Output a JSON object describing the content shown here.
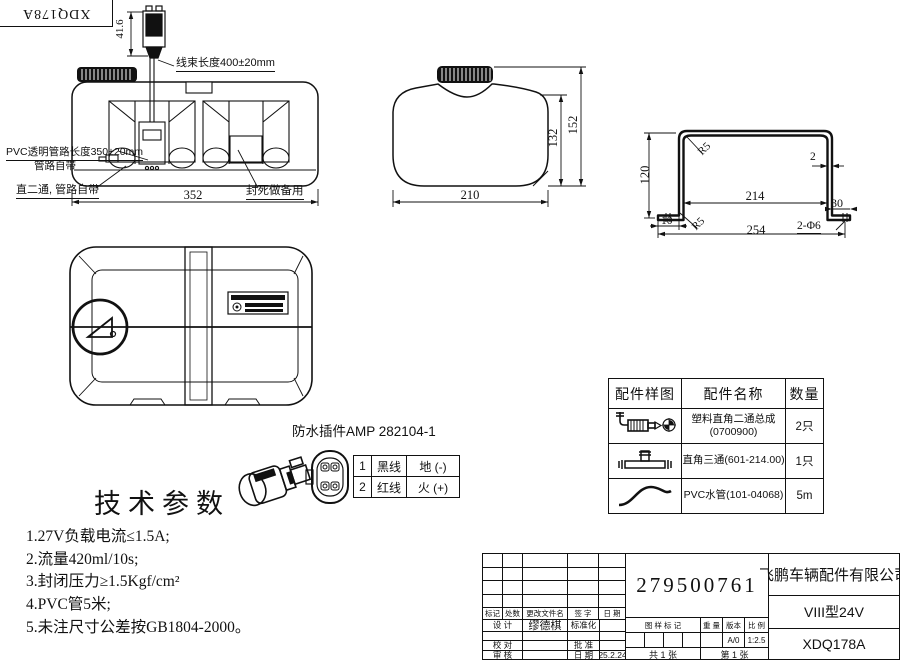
{
  "corner_stamp": "XDQ178A",
  "top_view": {
    "connector_height_dim": "41.6",
    "harness_label": "线束长度400±20mm",
    "pvc_label_1": "PVC透明管路长度350±20mm",
    "pvc_label_2": "管路自带",
    "tee_label": "直二通, 管路自带",
    "sealed_label": "封死做备用",
    "width_dim": "352"
  },
  "side_view": {
    "width_dim": "210",
    "inner_height_dim": "132",
    "outer_height_dim": "152"
  },
  "bracket": {
    "height_dim": "120",
    "inner_width_dim": "214",
    "outer_width_dim": "254",
    "right_flange_dim": "30",
    "left_flange_dim": "10",
    "thickness_dim": "2",
    "radius_top": "R5",
    "radius_bottom": "R5",
    "holes_label": "2-Φ6"
  },
  "connector": {
    "title": "防水插件AMP 282104-1",
    "rows": [
      {
        "no": "1",
        "wire": "黑线",
        "polarity": "地 (-)"
      },
      {
        "no": "2",
        "wire": "红线",
        "polarity": "火 (+)"
      }
    ]
  },
  "tech_params": {
    "title": "技术参数",
    "items": [
      "1.27V负载电流≤1.5A;",
      "2.流量420ml/10s;",
      "3.封闭压力≥1.5Kgf/cm²",
      "4.PVC管5米;",
      "5.未注尺寸公差按GB1804-2000。"
    ]
  },
  "parts_table": {
    "headers": [
      "配件样图",
      "配件名称",
      "数量"
    ],
    "rows": [
      {
        "icon": "elbow-two-way-fitting",
        "name": "塑料直角二通总成\n(0700900)",
        "qty": "2只"
      },
      {
        "icon": "tee-fitting",
        "name": "直角三通(601-214.00)",
        "qty": "1只"
      },
      {
        "icon": "pvc-pipe",
        "name": "PVC水管(101-04068)",
        "qty": "5m"
      }
    ]
  },
  "title_block": {
    "part_number": "279500761",
    "company": "飞鹏车辆配件有限公司",
    "model": "VIII型24V",
    "drawing_no": "XDQ178A",
    "rev_headers": [
      "标记",
      "处数",
      "更改文件名",
      "签 字",
      "日 期"
    ],
    "design_label": "设 计",
    "designer": "缪德棋",
    "standardization_label": "标准化",
    "check_label": "校 对",
    "approve_label": "批 准",
    "review_label": "审 核",
    "date_label": "日 期",
    "date": "25.2.24",
    "stamp_label": "图 样 标 记",
    "weight_label": "重 量",
    "version_label": "版本",
    "version": "A/0",
    "scale_label": "比 例",
    "scale": "1:2.5",
    "total_sheets": "共 1 张",
    "sheet_no": "第 1 张"
  }
}
